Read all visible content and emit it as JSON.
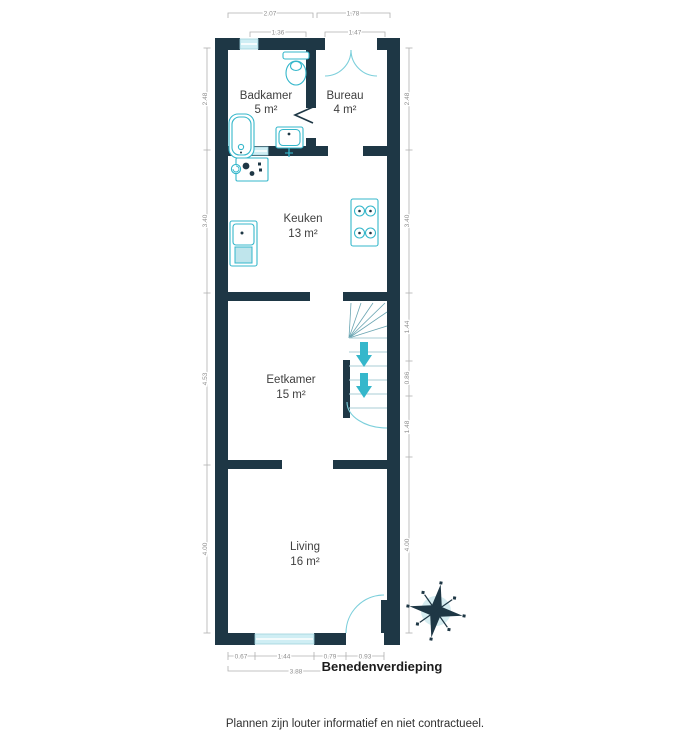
{
  "plan": {
    "title": "Benedenverdieping",
    "disclaimer": "Plannen zijn louter informatief en niet contractueel."
  },
  "rooms": [
    {
      "name": "Badkamer",
      "area": "5 m²"
    },
    {
      "name": "Bureau",
      "area": "4 m²"
    },
    {
      "name": "Keuken",
      "area": "13 m²"
    },
    {
      "name": "Eetkamer",
      "area": "15 m²"
    },
    {
      "name": "Living",
      "area": "16 m²"
    }
  ],
  "dims": {
    "top_row1": [
      "2.07",
      "1.78"
    ],
    "top_row2": [
      "1.36",
      "1.47"
    ],
    "left": [
      "2.48",
      "3.40",
      "4.53",
      "4.00"
    ],
    "right": [
      "2.48",
      "3.40",
      "1.44",
      "0.86",
      "1.48",
      "4.00"
    ],
    "bottom": [
      "0.67",
      "1.44",
      "0.79",
      "0.93"
    ],
    "bottom_total": "3.88"
  },
  "colors": {
    "wall": "#1e3745",
    "fixture": "#35b7cb",
    "window": "#cfeef4",
    "door": "#7ccfdb",
    "dim": "#8f8f8f",
    "label": "#3f3f3f",
    "title": "#1b1b1b"
  }
}
